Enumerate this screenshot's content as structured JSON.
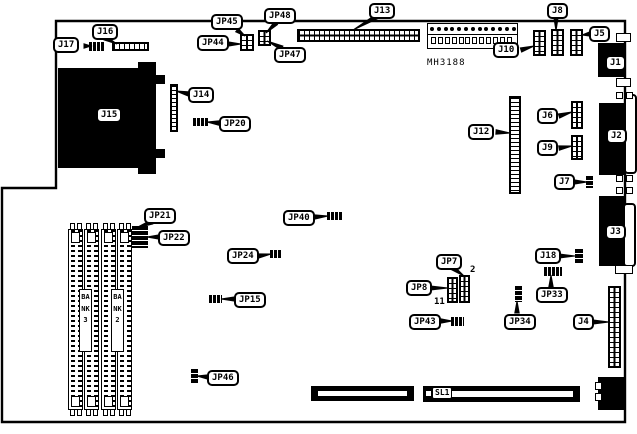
{
  "diagram": {
    "description": "Motherboard connector and jumper location diagram",
    "model_text": "MH3188",
    "colors": {
      "board_bg": "#ffffff",
      "ink": "#000000"
    },
    "bank_labels": [
      {
        "id": "bank3",
        "text": "BANK3"
      },
      {
        "id": "bank2",
        "text": "BANK2"
      }
    ],
    "pin_annotations": [
      {
        "id": "jp7-pin2",
        "text": "2"
      },
      {
        "id": "jp8-pin11",
        "text": "11"
      }
    ],
    "callouts": [
      {
        "id": "J17",
        "text": "J17"
      },
      {
        "id": "J16",
        "text": "J16"
      },
      {
        "id": "JP45",
        "text": "JP45"
      },
      {
        "id": "JP48",
        "text": "JP48"
      },
      {
        "id": "JP44",
        "text": "JP44"
      },
      {
        "id": "JP47",
        "text": "JP47"
      },
      {
        "id": "J13",
        "text": "J13"
      },
      {
        "id": "J8",
        "text": "J8"
      },
      {
        "id": "J5",
        "text": "J5"
      },
      {
        "id": "J10",
        "text": "J10"
      },
      {
        "id": "J1",
        "text": "J1"
      },
      {
        "id": "J14",
        "text": "J14"
      },
      {
        "id": "JP20",
        "text": "JP20"
      },
      {
        "id": "J15",
        "text": "J15"
      },
      {
        "id": "J12",
        "text": "J12"
      },
      {
        "id": "J6",
        "text": "J6"
      },
      {
        "id": "J9",
        "text": "J9"
      },
      {
        "id": "J2",
        "text": "J2"
      },
      {
        "id": "J7",
        "text": "J7"
      },
      {
        "id": "J3",
        "text": "J3"
      },
      {
        "id": "J18",
        "text": "J18"
      },
      {
        "id": "JP33",
        "text": "JP33"
      },
      {
        "id": "JP34",
        "text": "JP34"
      },
      {
        "id": "J4",
        "text": "J4"
      },
      {
        "id": "JP21",
        "text": "JP21"
      },
      {
        "id": "JP22",
        "text": "JP22"
      },
      {
        "id": "JP40",
        "text": "JP40"
      },
      {
        "id": "JP24",
        "text": "JP24"
      },
      {
        "id": "JP15",
        "text": "JP15"
      },
      {
        "id": "JP46",
        "text": "JP46"
      },
      {
        "id": "JP7",
        "text": "JP7"
      },
      {
        "id": "JP8",
        "text": "JP8"
      },
      {
        "id": "JP43",
        "text": "JP43"
      },
      {
        "id": "SL1",
        "text": "SL1"
      }
    ]
  }
}
